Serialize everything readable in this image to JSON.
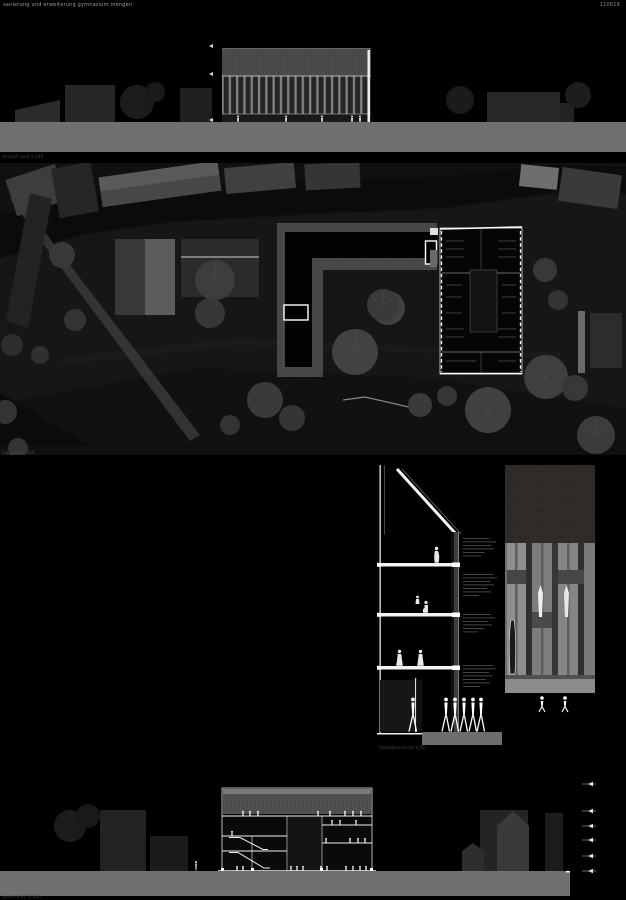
{
  "header": {
    "title": "sanierung und erweiterung gymnasium mengen",
    "sheet_no": "110618"
  },
  "drawings": {
    "elevation_north": {
      "label": "ansicht nord 1:200"
    },
    "site_plan": {
      "label": "lageplan 1:500"
    },
    "facade_section": {
      "label": "fassadenschnitt 1:50"
    },
    "cross_section": {
      "label": "querschnitt 1:200"
    }
  },
  "colors": {
    "background": "#000000",
    "ground_band": "#6f6f6f",
    "drawing_line": "#ffffff",
    "site_base": "#161616"
  }
}
